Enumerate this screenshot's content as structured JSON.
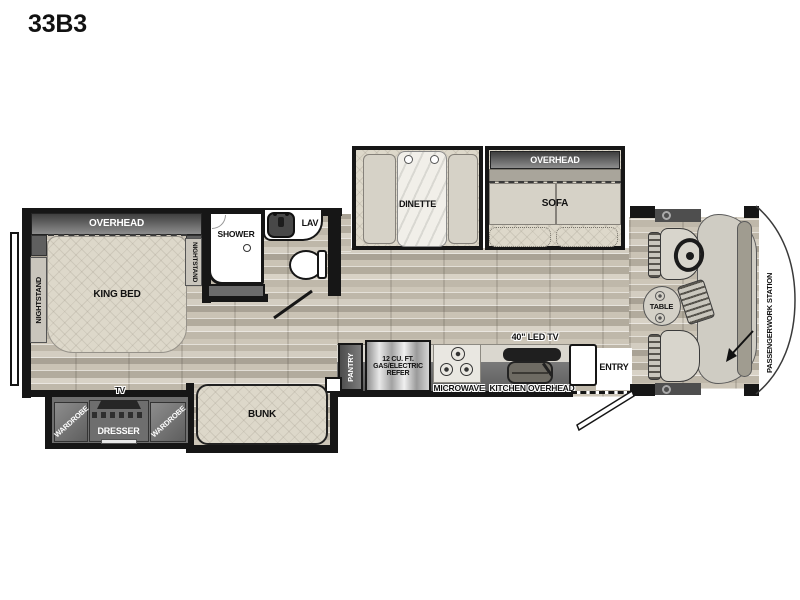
{
  "title": "33B3",
  "colors": {
    "wall": "#161616",
    "overhead_gradient_top": "#3f3f3f",
    "overhead_gradient_bottom": "#8d8d8d",
    "cabinet_gray": "#6b6b6b",
    "wood_floor": "#c3bcae",
    "fabric": "#ddd8ca",
    "background": "#ffffff"
  },
  "labels": {
    "bedroom": {
      "overhead": "OVERHEAD",
      "nightstand_left": "NIGHTSTAND",
      "nightstand_right": "NIGHTSTAND",
      "king_bed": "KING BED",
      "tv": "TV"
    },
    "bath": {
      "shower": "SHOWER",
      "lav": "LAV"
    },
    "living": {
      "dinette": "DINETTE",
      "overhead": "OVERHEAD",
      "sofa": "SOFA"
    },
    "kitchen": {
      "pantry": "PANTRY",
      "refer_line1": "12 CU. FT.",
      "refer_line2": "GAS/ELECTRIC",
      "refer_line3": "REFER",
      "microwave": "MICROWAVE",
      "led_tv": "40\" LED TV",
      "overhead": "KITCHEN OVERHEAD",
      "entry": "ENTRY"
    },
    "bunkroom": {
      "wardrobe_left": "WARDROBE",
      "dresser": "DRESSER",
      "wardrobe_right": "WARDROBE",
      "bunk": "BUNK"
    },
    "cab": {
      "table": "TABLE",
      "workstation_line1": "PASSENGER",
      "workstation_line2": "WORK STATION"
    }
  }
}
